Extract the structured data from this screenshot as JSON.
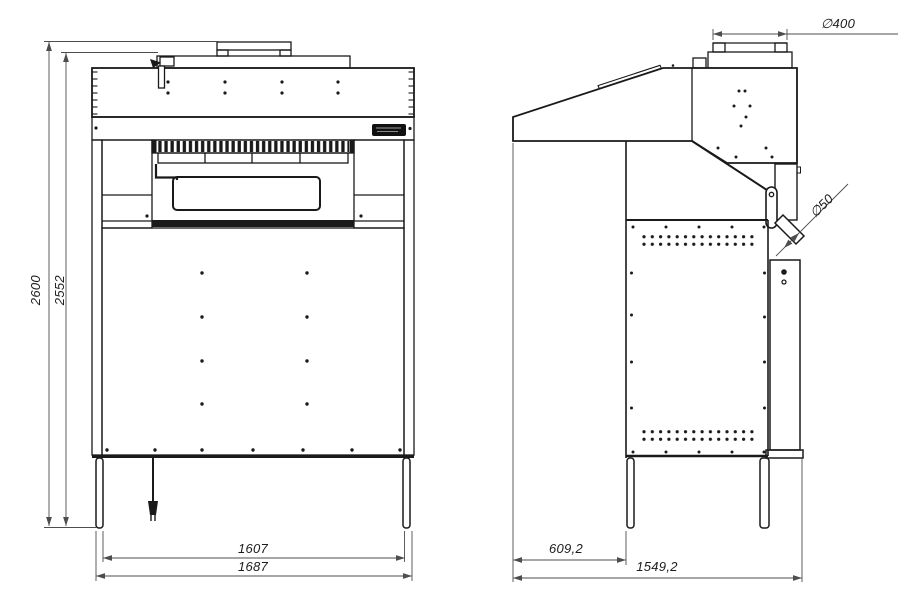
{
  "drawing_labels": {
    "front_view": {
      "overall_height": "2600",
      "cabinet_height": "2552",
      "leg_span_inner": "1607",
      "overall_width": "1687"
    },
    "side_view": {
      "duct_diameter": "∅400",
      "hose_diameter": "∅50",
      "hood_overhang_depth": "609,2",
      "overall_depth": "1549,2"
    }
  },
  "colors": {
    "line": "#1a1a1a",
    "dimension": "#4d4d4d"
  }
}
